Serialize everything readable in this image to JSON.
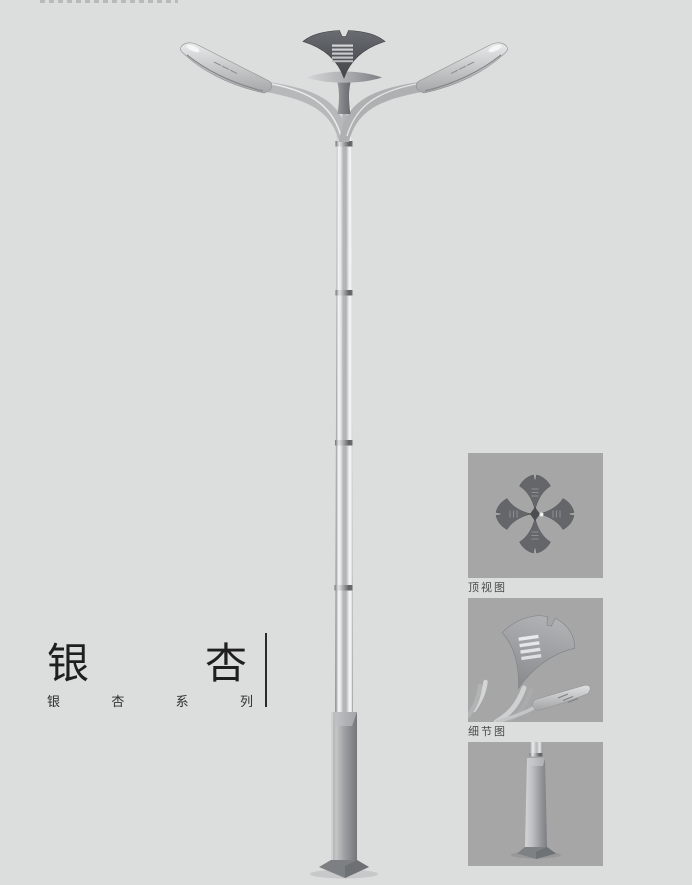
{
  "title": {
    "text": "银杏",
    "chars": [
      "银",
      "杏"
    ],
    "subtitle": "银杏系列",
    "subtitle_chars": [
      "银",
      "杏",
      "系",
      "列"
    ]
  },
  "side_panels": {
    "top_view_label": "顶视图",
    "detail_view_label": "细节图"
  },
  "colors": {
    "page_bg": "#dcdddd",
    "panel_bg": "#a6a6a6",
    "title_text": "#1f1f1f",
    "label_text": "#4a4a4a",
    "metal_light": "#d9dadb",
    "metal_mid": "#b4b6b8",
    "metal_dark": "#54575b",
    "crown_dark": "#46494d"
  }
}
